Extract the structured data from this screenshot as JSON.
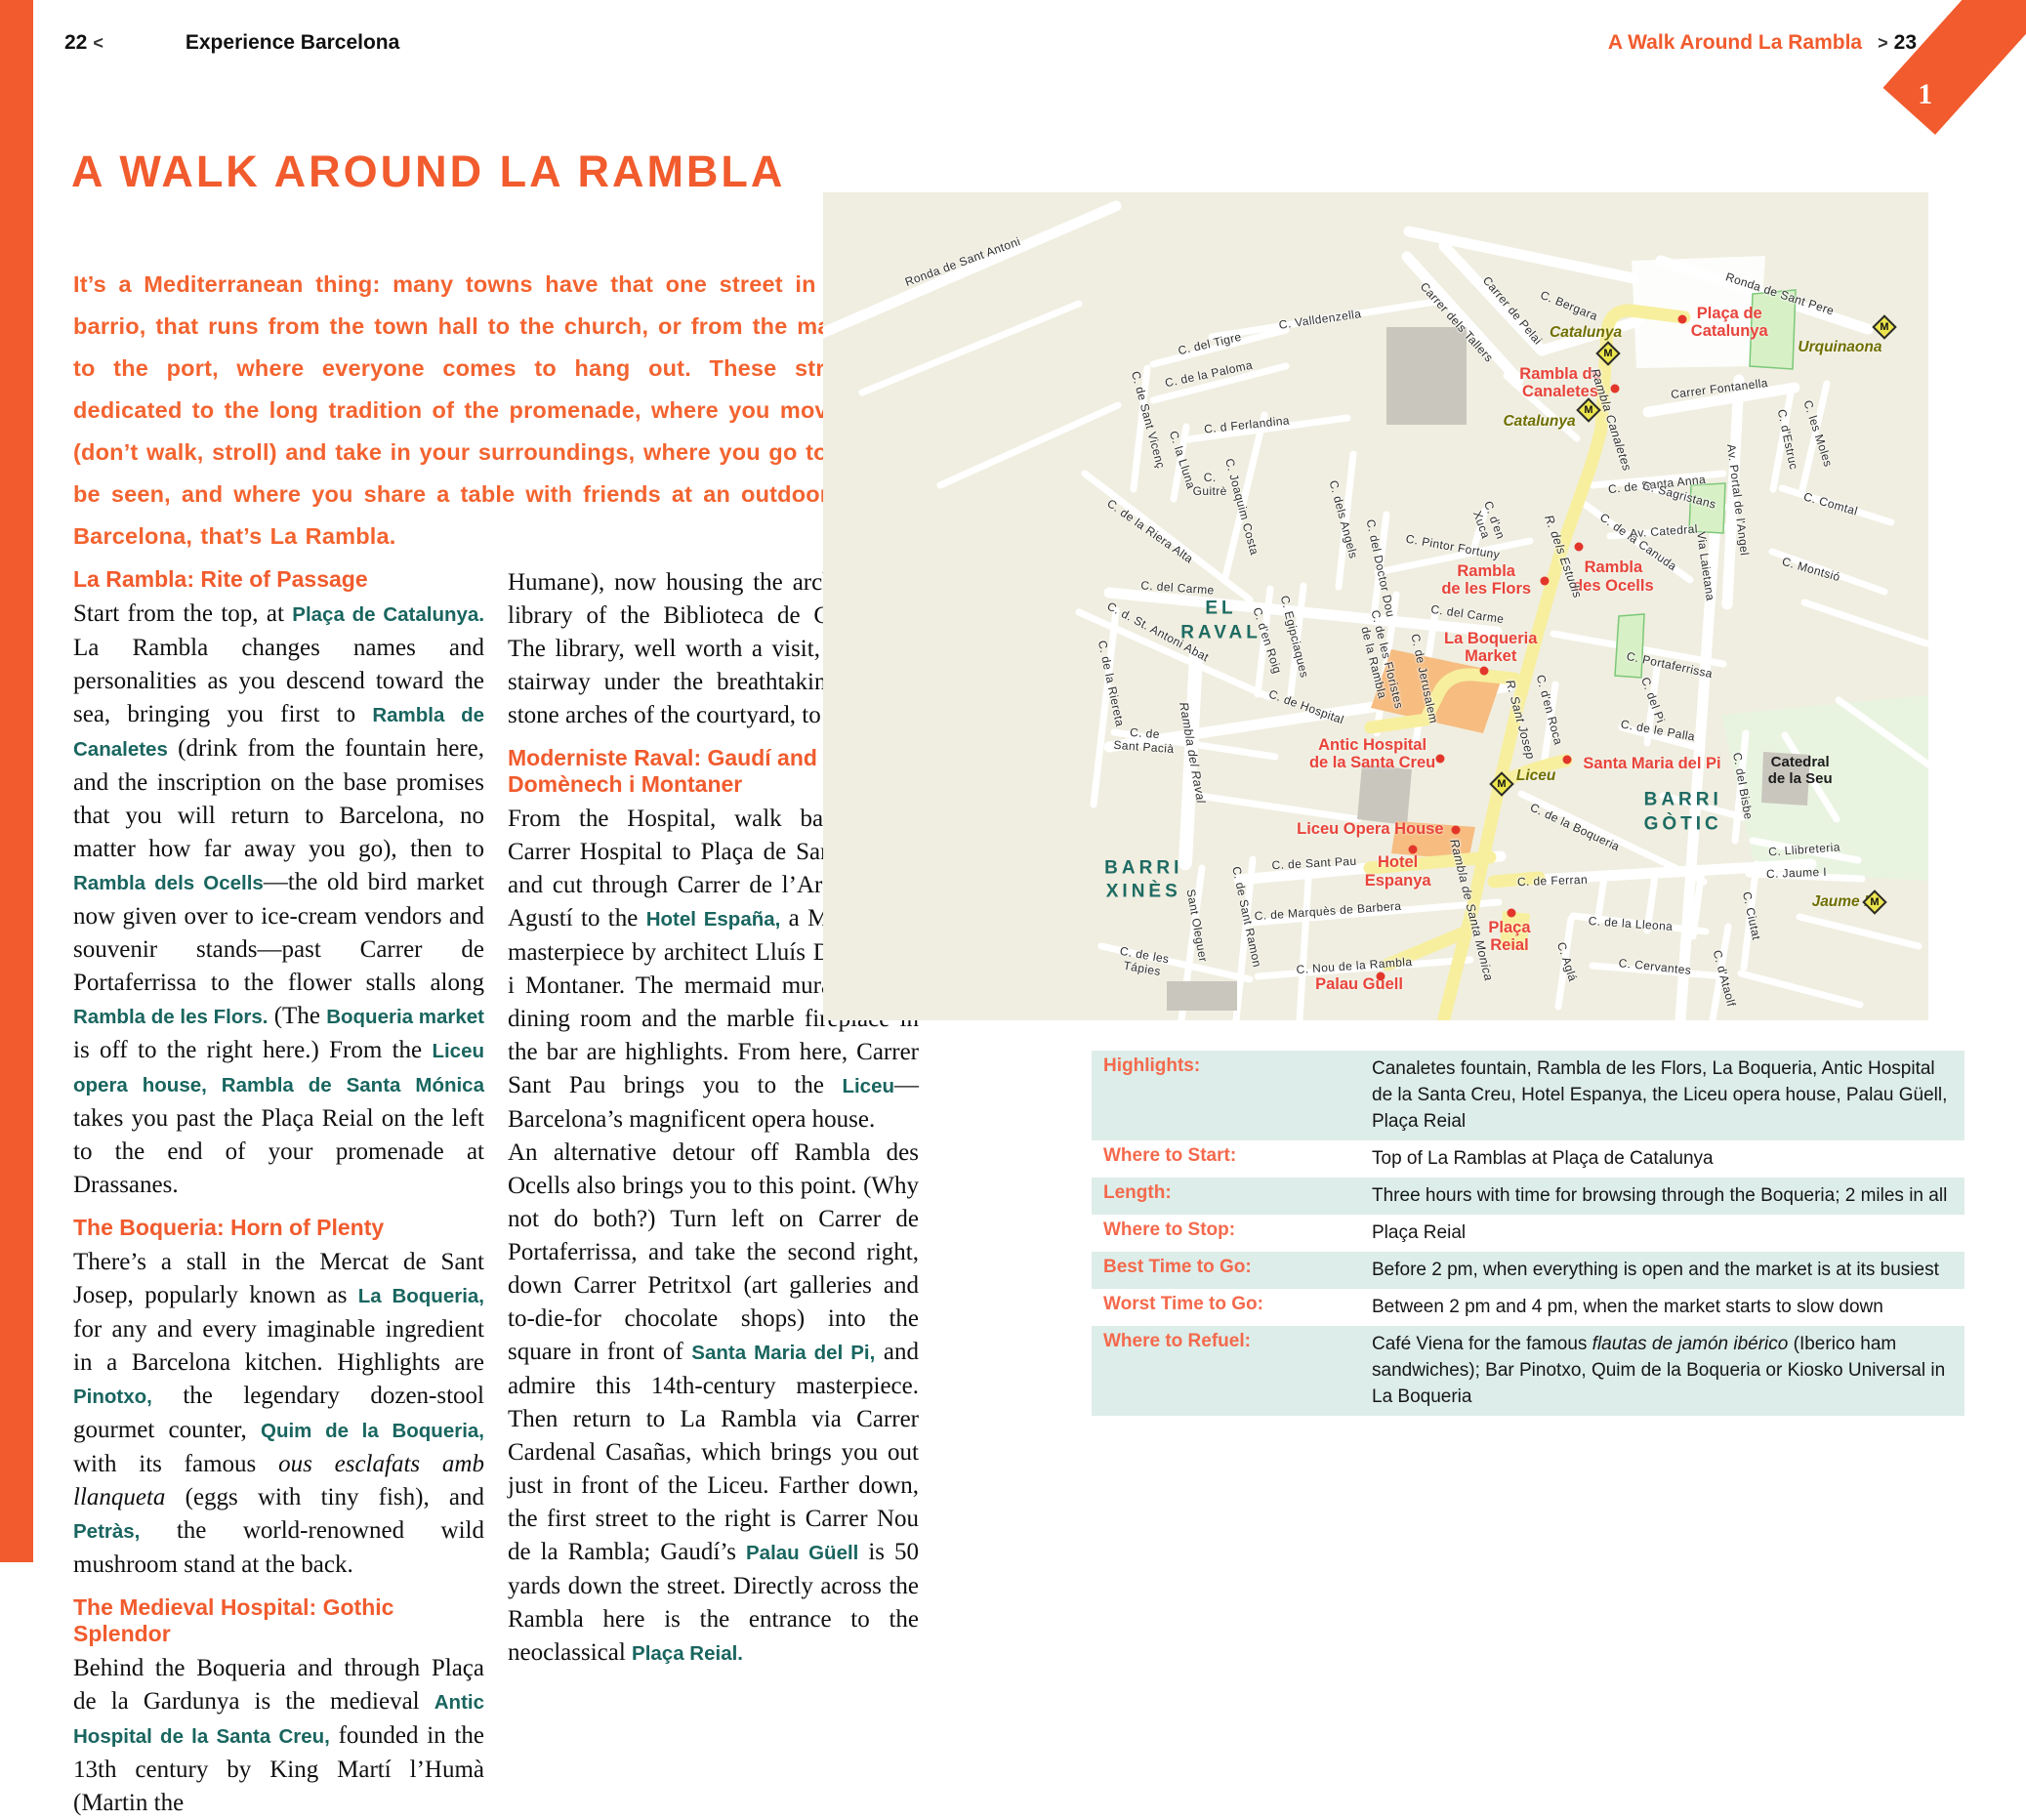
{
  "colors": {
    "accent": "#F15B2D",
    "teal": "#19655F",
    "poi_red": "#E8443B",
    "route_yellow": "#F7EF9E",
    "map_bg": "#F0EEE0",
    "row_tint": "#DDEDE9",
    "metro_olive": "#6F6F00"
  },
  "header": {
    "left_page_number": "22",
    "left_chevron": "<",
    "left_section": "Experience Barcelona",
    "right_title": "A Walk Around La Rambla",
    "right_chevron": ">",
    "right_page_number": "23",
    "chapter_tab": "1"
  },
  "title": "A WALK AROUND LA RAMBLA",
  "intro": "It’s a Mediterranean thing: many towns have that one street in town, or barrio, that runs from the town hall to the church, or from the main street to the port, where everyone comes to hang out. These streets are dedicated to the long tradition of the promenade, where you move slower (don’t walk, stroll) and take in your surroundings, where you go to see and be seen, and where you share a table with friends at an outdoor café. In Barcelona, that’s La Rambla.",
  "article": {
    "column1": [
      {
        "type": "h",
        "text": "La Rambla: Rite of Passage"
      },
      {
        "type": "p",
        "seg": [
          {
            "t": "Start from the top, at "
          },
          {
            "t": "Plaça de Catalunya.",
            "s": "b"
          },
          {
            "t": " La Rambla changes names and personalities as you descend toward the sea, bringing you first to "
          },
          {
            "t": "Rambla de Canaletes",
            "s": "b"
          },
          {
            "t": " (drink from the fountain here, and the inscription on the base promises that you will return to Barcelona, no matter how far away you go), then to "
          },
          {
            "t": "Rambla dels Ocells",
            "s": "b"
          },
          {
            "t": "—the old bird market now given over to ice-cream vendors and souvenir stands—past Carrer de Portaferrissa to the flower stalls along "
          },
          {
            "t": "Rambla de les Flors.",
            "s": "b"
          },
          {
            "t": " (The "
          },
          {
            "t": "Boqueria market",
            "s": "b"
          },
          {
            "t": " is off to the right here.) From the "
          },
          {
            "t": "Liceu opera house, Rambla de Santa Mónica",
            "s": "b"
          },
          {
            "t": " takes you past the Plaça Reial on the left to the end of your promenade at Drassanes."
          }
        ]
      },
      {
        "type": "h",
        "text": "The Boqueria: Horn of Plenty"
      },
      {
        "type": "p",
        "seg": [
          {
            "t": "There’s a stall in the Mercat de Sant Josep, popularly known as "
          },
          {
            "t": "La Boqueria,",
            "s": "b"
          },
          {
            "t": " for any and every imaginable ingredient in a Barcelona kitchen. Highlights are "
          },
          {
            "t": "Pinotxo,",
            "s": "b"
          },
          {
            "t": " the legendary dozen-stool gourmet counter, "
          },
          {
            "t": "Quim de la Boqueria,",
            "s": "b"
          },
          {
            "t": " with its famous "
          },
          {
            "t": "ous esclafats amb llanqueta",
            "s": "i"
          },
          {
            "t": " (eggs with tiny fish), and "
          },
          {
            "t": "Petràs,",
            "s": "b"
          },
          {
            "t": " the world-renowned wild mushroom stand at the back."
          }
        ]
      },
      {
        "type": "h",
        "text": "The Medieval Hospital: Gothic Splendor"
      },
      {
        "type": "p",
        "seg": [
          {
            "t": "Behind the Boqueria and through Plaça de la Gardunya is the medieval "
          },
          {
            "t": "Antic Hospital de la Santa Creu,",
            "s": "b"
          },
          {
            "t": " founded in the 13th century by King Martí l’Humà (Martin the"
          }
        ]
      }
    ],
    "column2": [
      {
        "type": "p",
        "seg": [
          {
            "t": "Humane), now housing the archives and library of the Biblioteca de Catalunya. The library, well worth a visit, is up the stairway under the breathtaking Gothic stone arches of the courtyard, to the right."
          }
        ]
      },
      {
        "type": "h",
        "text": "Moderniste Raval: Gaudí and Domènech i Montaner"
      },
      {
        "type": "p",
        "seg": [
          {
            "t": "From the Hospital, walk back along Carrer Hospital to Plaça de Sant Agustí, and cut through Carrer de l’Arc de Sant Agustí to the "
          },
          {
            "t": "Hotel España,",
            "s": "b"
          },
          {
            "t": " a Moderniste masterpiece by architect Lluís Domènech i Montaner. The mermaid murals in the dining room and the marble fireplace in the bar are highlights. From here, Carrer Sant Pau brings you to the "
          },
          {
            "t": "Liceu",
            "s": "b"
          },
          {
            "t": "—Barcelona’s magnificent opera house."
          }
        ]
      },
      {
        "type": "p",
        "seg": [
          {
            "t": "An alternative detour off Rambla des Ocells also brings you to this point. (Why not do both?) Turn left on Carrer de Portaferrissa, and take the second right, down Carrer Petritxol (art galleries and to-die-for chocolate shops) into the square in front of "
          },
          {
            "t": "Santa Maria del Pi,",
            "s": "b"
          },
          {
            "t": " and admire this 14th-century masterpiece. Then return to La Rambla via Carrer Cardenal Casañas, which brings you out just in front of the Liceu. Farther down, the first street to the right is Carrer Nou de la Rambla; Gaudí’s "
          },
          {
            "t": "Palau Güell",
            "s": "b"
          },
          {
            "t": " is 50 yards down the street. Directly across the Rambla here is the entrance to the neoclassical "
          },
          {
            "t": "Plaça Reial.",
            "s": "b"
          }
        ]
      }
    ]
  },
  "map": {
    "metro_letter": "M",
    "labels": [
      {
        "t": "Plaça de\nCatalunya",
        "x": 82.0,
        "y": 15.7,
        "c": "poi"
      },
      {
        "t": "Rambla de\nCanaletes",
        "x": 66.7,
        "y": 23.0,
        "c": "poi"
      },
      {
        "t": "Rambla\nde les Flors",
        "x": 60.0,
        "y": 46.8,
        "c": "poi"
      },
      {
        "t": "Rambla\ndes Ocells",
        "x": 71.5,
        "y": 46.4,
        "c": "poi"
      },
      {
        "t": "La Boqueria\nMarket",
        "x": 60.4,
        "y": 54.9,
        "c": "poi"
      },
      {
        "t": "Antic Hospital\nde la Santa Creu",
        "x": 49.7,
        "y": 67.8,
        "c": "poi"
      },
      {
        "t": "Santa Maria del Pi",
        "x": 75.0,
        "y": 69.0,
        "c": "poi"
      },
      {
        "t": "Liceu Opera House",
        "x": 49.5,
        "y": 76.9,
        "c": "poi"
      },
      {
        "t": "Hotel\nEspanya",
        "x": 52.0,
        "y": 82.0,
        "c": "poi"
      },
      {
        "t": "Plaça\nReial",
        "x": 62.1,
        "y": 89.9,
        "c": "poi"
      },
      {
        "t": "Palau Güell",
        "x": 48.5,
        "y": 95.6,
        "c": "poi"
      },
      {
        "t": "Catalunya",
        "x": 69.0,
        "y": 17.0,
        "c": "metro"
      },
      {
        "t": "Catalunya",
        "x": 64.8,
        "y": 27.7,
        "c": "metro"
      },
      {
        "t": "Urquinaona",
        "x": 92.0,
        "y": 18.7,
        "c": "metro"
      },
      {
        "t": "Liceu",
        "x": 64.5,
        "y": 70.5,
        "c": "metro"
      },
      {
        "t": "Jaume I",
        "x": 92.0,
        "y": 85.7,
        "c": "metro"
      },
      {
        "t": "EL\nRAVAL",
        "x": 36.0,
        "y": 51.8,
        "c": "district"
      },
      {
        "t": "BARRI\nXINÈS",
        "x": 29.0,
        "y": 83.1,
        "c": "district"
      },
      {
        "t": "BARRI\nGÒTIC",
        "x": 77.8,
        "y": 74.9,
        "c": "district"
      },
      {
        "t": "Catedral\nde la Seu",
        "x": 88.4,
        "y": 69.8,
        "c": "bldg"
      },
      {
        "t": "Ronda de Sant Antoni",
        "x": 12.6,
        "y": 8.4,
        "r": -20,
        "c": "street"
      },
      {
        "t": "C. Valldenzella",
        "x": 45.0,
        "y": 15.3,
        "r": -8,
        "c": "street"
      },
      {
        "t": "Carrer dels Tallers",
        "x": 57.3,
        "y": 15.7,
        "r": 48,
        "c": "street"
      },
      {
        "t": "Carrer de Pelai",
        "x": 62.4,
        "y": 14.3,
        "r": 50,
        "c": "street"
      },
      {
        "t": "C. Bergara",
        "x": 67.5,
        "y": 13.7,
        "r": 22,
        "c": "street"
      },
      {
        "t": "Ronda de Sant Pere",
        "x": 86.6,
        "y": 12.3,
        "r": 18,
        "c": "street"
      },
      {
        "t": "Carrer Fontanella",
        "x": 81.1,
        "y": 23.7,
        "r": -7,
        "c": "street"
      },
      {
        "t": "C. del Tigre",
        "x": 35.0,
        "y": 18.3,
        "r": -13,
        "c": "street"
      },
      {
        "t": "C. de la Paloma",
        "x": 34.9,
        "y": 21.9,
        "r": -12,
        "c": "street"
      },
      {
        "t": "C. de Sant Vicenç",
        "x": 29.4,
        "y": 27.5,
        "r": 75,
        "c": "street"
      },
      {
        "t": "C. la Lluna",
        "x": 32.5,
        "y": 32.3,
        "r": 72,
        "c": "street"
      },
      {
        "t": "C. d Ferlandina",
        "x": 38.3,
        "y": 28.1,
        "r": -6,
        "c": "street"
      },
      {
        "t": "C.\nGuitrè",
        "x": 35.0,
        "y": 35.3,
        "r": 0,
        "c": "street"
      },
      {
        "t": "C. Joaquim Costa",
        "x": 37.9,
        "y": 38.0,
        "r": 75,
        "c": "street"
      },
      {
        "t": "C. dels Angels",
        "x": 47.1,
        "y": 39.5,
        "r": 75,
        "c": "street"
      },
      {
        "t": "C. del Doctor Dou",
        "x": 50.4,
        "y": 45.4,
        "r": 78,
        "c": "street"
      },
      {
        "t": "C. Pintor Fortuny",
        "x": 57.0,
        "y": 42.8,
        "r": 10,
        "c": "street"
      },
      {
        "t": "C. d'en\nXuca",
        "x": 60.2,
        "y": 39.9,
        "r": 70,
        "c": "street"
      },
      {
        "t": "C. de la Riera Alta",
        "x": 29.6,
        "y": 40.9,
        "r": 35,
        "c": "street"
      },
      {
        "t": "C. del Carme",
        "x": 32.1,
        "y": 47.8,
        "r": 4,
        "c": "street"
      },
      {
        "t": "C. del Carme",
        "x": 58.3,
        "y": 51.0,
        "r": 8,
        "c": "street"
      },
      {
        "t": "C. d. St. Antoni Abat",
        "x": 30.3,
        "y": 53.1,
        "r": 28,
        "c": "street"
      },
      {
        "t": "C. de la Riereta",
        "x": 26.1,
        "y": 59.3,
        "r": 78,
        "c": "street"
      },
      {
        "t": "C. d'en Roig",
        "x": 40.2,
        "y": 54.1,
        "r": 72,
        "c": "street"
      },
      {
        "t": "C. Egipciaques",
        "x": 42.7,
        "y": 53.7,
        "r": 76,
        "c": "street"
      },
      {
        "t": "C. de les Floristes\nde la Rambla",
        "x": 50.4,
        "y": 56.6,
        "r": 76,
        "c": "street"
      },
      {
        "t": "C. de Jerusalem",
        "x": 54.4,
        "y": 58.7,
        "r": 78,
        "c": "street"
      },
      {
        "t": "C. de Hospital",
        "x": 43.7,
        "y": 62.1,
        "r": 20,
        "c": "street"
      },
      {
        "t": "C. de\nSant Pacià",
        "x": 29.1,
        "y": 66.2,
        "r": 4,
        "c": "street"
      },
      {
        "t": "Rambla del Raval",
        "x": 33.4,
        "y": 67.7,
        "r": 80,
        "c": "street",
        "i": 1
      },
      {
        "t": "Sant Oleguer",
        "x": 33.8,
        "y": 88.6,
        "r": 80,
        "c": "street"
      },
      {
        "t": "C. de Sant Ramon",
        "x": 38.3,
        "y": 87.5,
        "r": 78,
        "c": "street"
      },
      {
        "t": "C. de les\nTápies",
        "x": 29.0,
        "y": 92.9,
        "r": 10,
        "c": "street"
      },
      {
        "t": "C. de Sant Pau",
        "x": 44.4,
        "y": 81.0,
        "r": -3,
        "c": "street"
      },
      {
        "t": "C. de Marquès de Barbera",
        "x": 45.7,
        "y": 86.8,
        "r": -4,
        "c": "street"
      },
      {
        "t": "C. Nou de la Rambla",
        "x": 48.1,
        "y": 93.4,
        "r": -4,
        "c": "street"
      },
      {
        "t": "Rambla Canaletes",
        "x": 71.3,
        "y": 27.5,
        "r": 72,
        "c": "street",
        "i": 1
      },
      {
        "t": "R. dels Estudis",
        "x": 67.0,
        "y": 44.0,
        "r": 70,
        "c": "street",
        "i": 1
      },
      {
        "t": "R. Sant Josep",
        "x": 63.1,
        "y": 63.7,
        "r": 75,
        "c": "street",
        "i": 1
      },
      {
        "t": "C. d'en Roca",
        "x": 65.7,
        "y": 62.5,
        "r": 75,
        "c": "street"
      },
      {
        "t": "Rambla de Santa Monica",
        "x": 58.7,
        "y": 86.7,
        "r": 76,
        "c": "street",
        "i": 1
      },
      {
        "t": "C. de la Boqueria",
        "x": 68.0,
        "y": 76.7,
        "r": 25,
        "c": "street"
      },
      {
        "t": "C. de Ferran",
        "x": 66.0,
        "y": 83.1,
        "r": -2,
        "c": "street"
      },
      {
        "t": "C. de la Lleona",
        "x": 73.1,
        "y": 88.3,
        "r": 4,
        "c": "street"
      },
      {
        "t": "C. Cervantes",
        "x": 75.3,
        "y": 93.5,
        "r": 6,
        "c": "street"
      },
      {
        "t": "C. Aglá",
        "x": 67.3,
        "y": 92.9,
        "r": 72,
        "c": "street"
      },
      {
        "t": "C. Ciutat",
        "x": 84.0,
        "y": 87.4,
        "r": 78,
        "c": "street"
      },
      {
        "t": "C. d'Ataolf",
        "x": 81.5,
        "y": 94.9,
        "r": 75,
        "c": "street"
      },
      {
        "t": "C. del Bisbe",
        "x": 83.2,
        "y": 71.7,
        "r": 80,
        "c": "street"
      },
      {
        "t": "C. Llibreteria",
        "x": 88.8,
        "y": 79.4,
        "r": -4,
        "c": "street"
      },
      {
        "t": "C. Jaume I",
        "x": 88.1,
        "y": 82.2,
        "r": -2,
        "c": "street"
      },
      {
        "t": "C. de la Canuda",
        "x": 73.8,
        "y": 42.2,
        "r": 35,
        "c": "street"
      },
      {
        "t": "C. de Santa Anna",
        "x": 75.4,
        "y": 35.3,
        "r": -6,
        "c": "street"
      },
      {
        "t": "Av. Portal de l'Angel",
        "x": 82.8,
        "y": 37.1,
        "r": 83,
        "c": "street"
      },
      {
        "t": "C. d'Estruc",
        "x": 87.3,
        "y": 29.8,
        "r": 78,
        "c": "street"
      },
      {
        "t": "C. les Moles",
        "x": 90.0,
        "y": 29.1,
        "r": 72,
        "c": "street"
      },
      {
        "t": "C. Comtal",
        "x": 91.2,
        "y": 37.6,
        "r": 16,
        "c": "street"
      },
      {
        "t": "C. Montsió",
        "x": 89.4,
        "y": 45.5,
        "r": 16,
        "c": "street"
      },
      {
        "t": "C. Sagristans",
        "x": 77.5,
        "y": 36.6,
        "r": 15,
        "c": "street"
      },
      {
        "t": "Av. Catedral",
        "x": 76.1,
        "y": 40.9,
        "r": -4,
        "c": "street"
      },
      {
        "t": "Via Laietana",
        "x": 79.9,
        "y": 45.2,
        "r": 82,
        "c": "street"
      },
      {
        "t": "C. Portaferrissa",
        "x": 76.6,
        "y": 57.1,
        "r": 12,
        "c": "street"
      },
      {
        "t": "C. del Pi",
        "x": 75.1,
        "y": 61.3,
        "r": 70,
        "c": "street"
      },
      {
        "t": "C. de le Palla",
        "x": 75.5,
        "y": 65.0,
        "r": 10,
        "c": "street"
      }
    ],
    "dots": [
      {
        "x": 77.7,
        "y": 15.3
      },
      {
        "x": 71.6,
        "y": 23.7
      },
      {
        "x": 68.4,
        "y": 42.8
      },
      {
        "x": 65.3,
        "y": 46.9
      },
      {
        "x": 59.8,
        "y": 57.8
      },
      {
        "x": 55.8,
        "y": 68.4
      },
      {
        "x": 67.3,
        "y": 68.5
      },
      {
        "x": 57.2,
        "y": 77.0
      },
      {
        "x": 53.4,
        "y": 79.4
      },
      {
        "x": 62.3,
        "y": 87.0
      },
      {
        "x": 50.4,
        "y": 94.7
      }
    ],
    "metro_icons": [
      {
        "x": 71.0,
        "y": 19.5
      },
      {
        "x": 69.3,
        "y": 26.3
      },
      {
        "x": 96.0,
        "y": 16.3
      },
      {
        "x": 61.4,
        "y": 71.5
      },
      {
        "x": 95.1,
        "y": 85.7
      }
    ]
  },
  "infobox": {
    "rows": [
      {
        "label": "Highlights:",
        "seg": [
          {
            "t": "Canaletes fountain, Rambla de les Flors, La Boqueria, Antic Hospital de la Santa Creu, Hotel Espanya, the Liceu opera house, Palau Güell, Plaça Reial"
          }
        ]
      },
      {
        "label": "Where to Start:",
        "seg": [
          {
            "t": "Top of La Ramblas at Plaça de Catalunya"
          }
        ]
      },
      {
        "label": "Length:",
        "seg": [
          {
            "t": "Three hours with time for browsing through the Boqueria; 2 miles in all"
          }
        ]
      },
      {
        "label": "Where to Stop:",
        "seg": [
          {
            "t": "Plaça Reial"
          }
        ]
      },
      {
        "label": "Best Time to Go:",
        "seg": [
          {
            "t": "Before 2 pm, when everything is open and the market is at its busiest"
          }
        ]
      },
      {
        "label": "Worst Time to Go:",
        "seg": [
          {
            "t": "Between 2 pm and 4 pm, when the market starts to slow down"
          }
        ]
      },
      {
        "label": "Where to Refuel:",
        "seg": [
          {
            "t": "Café Viena for the famous "
          },
          {
            "t": "flautas de jamón ibérico",
            "s": "i"
          },
          {
            "t": " (Iberico ham sandwiches); Bar Pinotxo, Quim de la Boqueria or Kiosko Universal in La Boqueria"
          }
        ]
      }
    ]
  }
}
